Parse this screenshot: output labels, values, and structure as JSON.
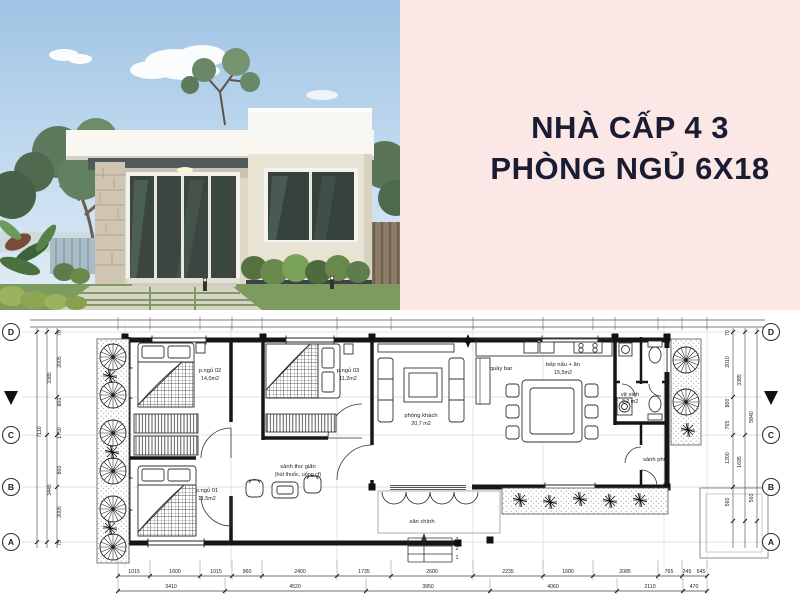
{
  "colors": {
    "background_pink": "#fbe8e6",
    "title_text": "#191c33",
    "plan_background": "#ffffff",
    "plan_ink": "#1c1c1c"
  },
  "title": {
    "line1": "NHÀ CẤP 4 3",
    "line2": "PHÒNG NGỦ 6X18"
  },
  "plan": {
    "grid_rows": [
      "D",
      "C",
      "B",
      "A"
    ],
    "steps": [
      "3",
      "2",
      "1"
    ],
    "rooms": [
      {
        "name": "p.ngủ 02",
        "area": "14,0m2"
      },
      {
        "name": "p.ngủ 03",
        "area": "11,2m2"
      },
      {
        "name": "p.ngủ 01",
        "area": "11,5m2"
      },
      {
        "name": "phòng khách",
        "area": "20,7 m2"
      },
      {
        "name": "quầy bar",
        "area": ""
      },
      {
        "name": "bếp nấu + ăn",
        "area": "15,5m2"
      },
      {
        "name": "vệ sinh",
        "area": "3,2 m2"
      },
      {
        "name": "sảnh phụ",
        "area": ""
      },
      {
        "name": "sảnh thư giãn",
        "note": "(hút thuốc, uống cf)"
      },
      {
        "name": "sân chính",
        "area": ""
      }
    ],
    "dims": {
      "bottom_segments": [
        "1015",
        "1600",
        "1015",
        "960",
        "2400",
        "1735",
        "2600",
        "2235",
        "1600",
        "2085",
        "765",
        "245",
        "545"
      ],
      "bottom_totals": [
        "3410",
        "4520",
        "3950",
        "4060",
        "2110",
        "470"
      ],
      "left_segments": [
        "2005",
        "800",
        "1750",
        "800",
        "2005"
      ],
      "left_subtotals": [
        "3385",
        "3445"
      ],
      "left_total": "7110",
      "left_edge": [
        "70",
        "75"
      ],
      "right_segments": [
        "2010",
        "800",
        "765",
        "1200",
        "560"
      ],
      "right_subtotals": [
        "3385",
        "1695",
        "560"
      ],
      "right_total": "5840",
      "right_edge": [
        "70"
      ]
    }
  }
}
